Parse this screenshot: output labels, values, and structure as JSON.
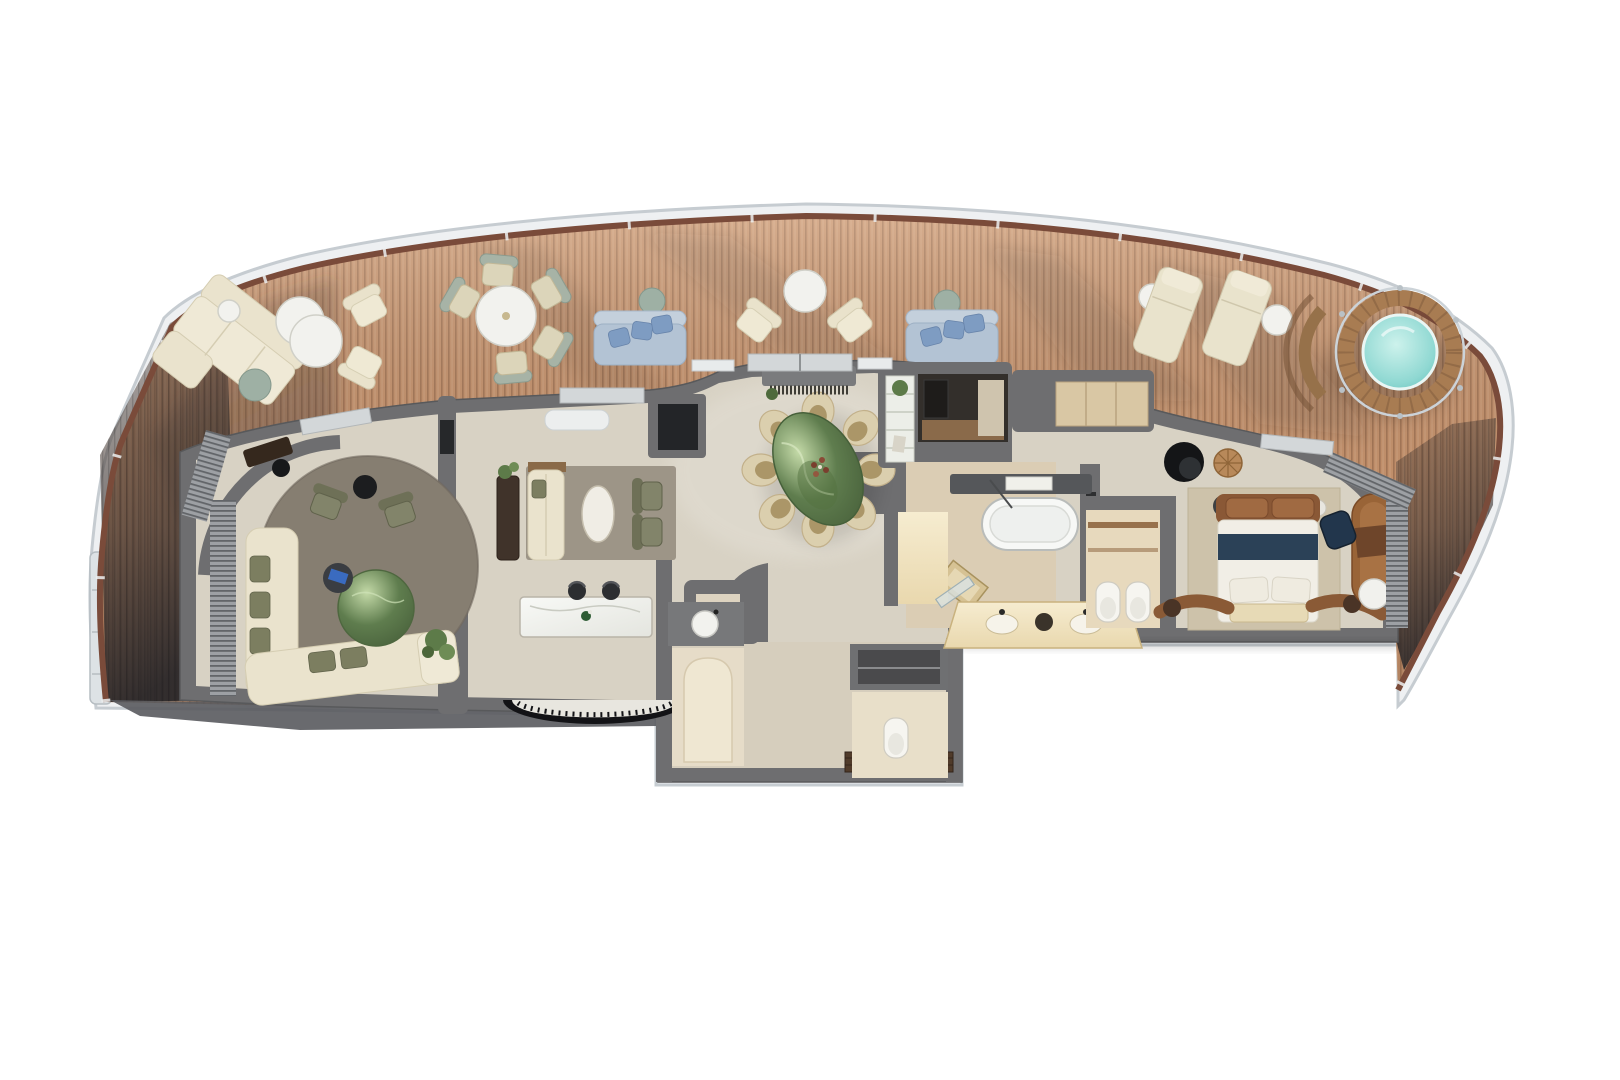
{
  "figure": {
    "kind": "cruise-ship-suite-floor-plan",
    "view": "top-down-3d-render",
    "background": "#ffffff"
  },
  "palette": {
    "deck_wood": "#c8946e",
    "deck_stripe": "rgba(82,46,27,0.28)",
    "hull": "#eef0f2",
    "hull_edge": "#c6ccd1",
    "rail": "#7a4b3a",
    "wall": "#6e6e70",
    "floor": "#d8d2c4",
    "floor_warm": "#ddd0ba",
    "rug_round": "#867e71",
    "rug_living": "#9a9184",
    "rug_bedroom": "#cdc2aa",
    "sofa_cream": "#eae3cd",
    "pillow_olive": "#7c7e60",
    "daybed_blue": "#b3c3d4",
    "pillow_blue": "#7e9cc2",
    "table_white": "#f2f2ee",
    "table_sage": "#9eb0a4",
    "marble_green": "#5f7d4e",
    "water": "#8fd8d2",
    "teak": "#a87c52",
    "counter_marble": "#eff0ea",
    "piano_black": "#131316",
    "bed_white": "#f1eee6",
    "bed_navy": "#2b4157",
    "leather_brown": "#925f38",
    "travertine": "#dbcdb4",
    "vanity_cream": "#e9d8ae",
    "closet_beige": "#e2d4ba",
    "curtain": "#9da0a4",
    "entry_mat": "#503b2a",
    "shadow": "#32343a"
  },
  "areas": [
    {
      "label": "wrap-around veranda deck",
      "furniture": [
        "sectional sofa",
        "round coffee tables",
        "lounge armchairs",
        "outdoor dining table with chairs",
        "two chaise daybeds with blue pillows",
        "two armchair pairs",
        "two sun loungers"
      ]
    },
    {
      "label": "whirlpool terrace",
      "furniture": [
        "round whirlpool spa",
        "teak surround",
        "curved bench"
      ]
    },
    {
      "label": "circular sitting room",
      "furniture": [
        "round rug",
        "green marble cocktail table",
        "L-shaped sofa",
        "two olive armchairs",
        "writing desk",
        "media console",
        "curtains"
      ]
    },
    {
      "label": "living room",
      "furniture": [
        "area rug",
        "sofa",
        "oval coffee table",
        "two olive armchairs",
        "wall console"
      ]
    },
    {
      "label": "piano bar lounge",
      "furniture": [
        "marble bar counter",
        "two bar stools",
        "curved piano with keys"
      ]
    },
    {
      "label": "dining foyer",
      "furniture": [
        "green marble dining table",
        "eight petal chairs",
        "console with fringe"
      ]
    },
    {
      "label": "butler pantry",
      "furniture": [
        "shelf unit with plant",
        "galley niche",
        "wood counter"
      ]
    },
    {
      "label": "entry corridor",
      "furniture": [
        "double entry mats",
        "storage niche"
      ]
    },
    {
      "label": "powder room",
      "furniture": [
        "counter with round basin",
        "arched shower niche"
      ]
    },
    {
      "label": "guest wc",
      "furniture": [
        "toilet"
      ]
    },
    {
      "label": "master bathroom",
      "furniture": [
        "freestanding oval bathtub",
        "double vanity with sinks",
        "walk-in shower",
        "leaning mirror"
      ]
    },
    {
      "label": "private wc room",
      "furniture": [
        "toilet",
        "bidet",
        "wood shelving"
      ]
    },
    {
      "label": "dressing closet",
      "furniture": [
        "wardrobe niche"
      ]
    },
    {
      "label": "master bedroom",
      "furniture": [
        "king bed with navy runner",
        "leather headboard",
        "foot bench",
        "bedside tables",
        "leather chaise",
        "writing desk with navy chair",
        "black swivel chair",
        "rattan side table",
        "curtains"
      ]
    }
  ]
}
